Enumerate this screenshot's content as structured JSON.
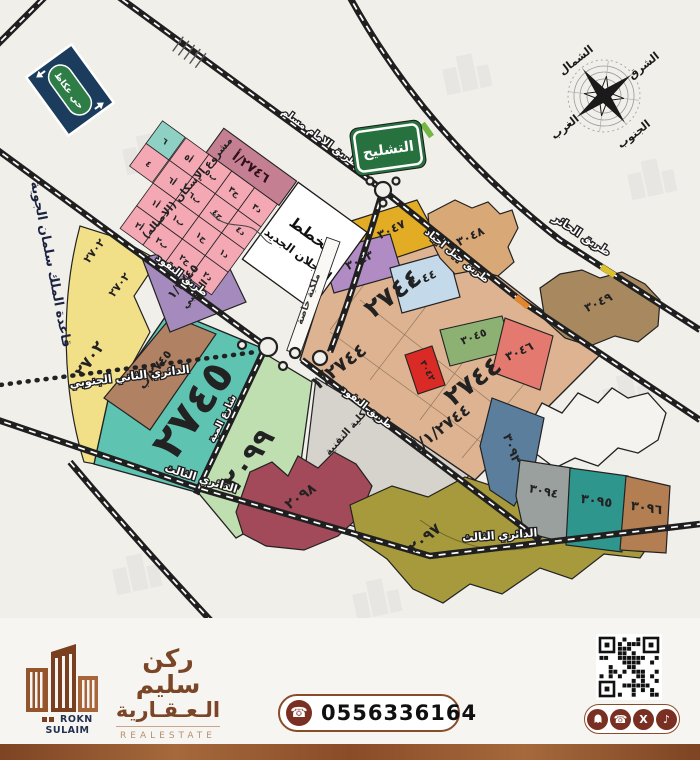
{
  "signs": {
    "okaz": "حي عكاظ",
    "tashleeh": "التشليح"
  },
  "compass": {
    "north": "الشمال",
    "south": "الجنوب",
    "east": "الشرق",
    "west": "الغرب"
  },
  "roads": {
    "imam_muslim": "طريق الامام مسلم",
    "alhair": "طريق الحائر",
    "jabal_ajyad": "طريق جبل اجياد",
    "alnafud": "طريق النفود",
    "alnafud2": "طريق النفود",
    "dairi2": "الدائري الثاني الجنوبي",
    "dairi3": "الدائري الثالث",
    "dairi3b": "الدائري الثالث",
    "almayah": "شارع المية"
  },
  "labels": {
    "airbase": "قاعدة الملك سلمان الجوية",
    "housing_project": "مشروع الإسكان (الاصاله)",
    "plan_line1": "مخطط",
    "plan_line2": "العجلان الجديد",
    "private_ownership": "ملكية خاصة",
    "college": "كلية التقنية"
  },
  "plots": {
    "p2746": "٢٧٤٦/أ",
    "p2745": "٢٧٤٥",
    "p2745b": "٢٧٤٥/ب",
    "p2745_1": "١/٢٧٤٥",
    "p2745_1b": "الذهبي",
    "p2702a": "٢٧٠٢",
    "p2702b": "٢٧٠٢",
    "p2702c": "٢٧٠٢",
    "p2744a": "٢٧٤٤",
    "p2744b": "١/٢٧٤٤",
    "p2744c": "٢٧٤٤",
    "p2744d": "١/٢٧٤٤/أ",
    "p2099": "٢٠٩٩",
    "p2098": "٢٠٩٨",
    "p2097": "٢٠٩٧",
    "p3042": "٣٠٤٢",
    "p3043": "٣٠٤٣",
    "p3044": "٣٠٤٤",
    "p3045": "٣٠٤٥",
    "p3046": "٣٠٤٦",
    "p3047": "٣٠٤٧",
    "p3048": "٣٠٤٨",
    "p3049": "٣٠٤٩",
    "p3093": "٣٠٩٣",
    "p3094": "٣٠٩٤",
    "p3095": "٣٠٩٥",
    "p3096": "٣٠٩٦"
  },
  "grid": [
    "أ٥",
    "ب٥",
    "ج٣",
    "د٣",
    "أ٦",
    "ب٦",
    "ج٤",
    "د٤",
    "أ١",
    "ب١",
    "ج١",
    "د١",
    "أ٢",
    "ب٢",
    "ج٢",
    "د٢"
  ],
  "grid_side": [
    "٦",
    "٤"
  ],
  "footer": {
    "brand_en": "ROKN SULAIM",
    "brand_ar_1": "ركن سليم",
    "brand_ar_2": "الـعـقـارية",
    "brand_sub": "REALESTATE",
    "phone": "0556336164"
  },
  "colors": {
    "map_bg": "#f1efea",
    "accent_brown": "#7b4627",
    "footer_bar": "#8a4c28",
    "teal_2745": "#5fc3b2",
    "yellow_2702": "#f2e089",
    "pink_grid": "#f3a8b4",
    "tan_2744": "#ddb392",
    "olive_2097": "#a79a3c",
    "maroon_2098": "#a34a5a"
  }
}
